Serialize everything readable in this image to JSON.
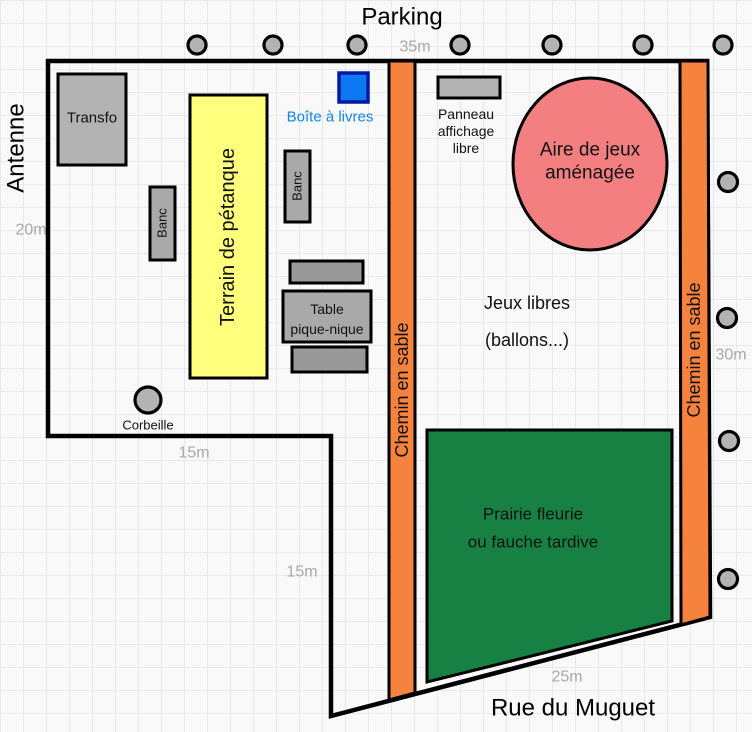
{
  "diagram": {
    "titles": {
      "parking": "Parking",
      "antenne": "Antenne",
      "rue_du_muguet": "Rue du Muguet"
    },
    "dimensions": {
      "top": "35m",
      "left": "20m",
      "right": "30m",
      "inner_west": "15m",
      "inner_south": "15m",
      "road": "25m"
    },
    "zones": {
      "terrain_petanque": {
        "label": "Terrain de pétanque",
        "fill": "#ffff7d"
      },
      "aire_de_jeux": {
        "lines": [
          "Aire de jeux",
          "aménagée"
        ],
        "fill": "#f47f80"
      },
      "prairie": {
        "lines": [
          "Prairie fleurie",
          "ou fauche tardive"
        ],
        "fill": "#178143"
      },
      "jeux_libres": {
        "lines": [
          "Jeux libres",
          "(ballons...)"
        ]
      },
      "chemin_ouest": {
        "label": "Chemin en sable",
        "fill": "#f5823d"
      },
      "chemin_est": {
        "label": "Chemin en sable",
        "fill": "#f5823d"
      }
    },
    "equipments": {
      "transfo": {
        "label": "Transfo",
        "fill": "#b3b3b3"
      },
      "boite_a_livres": {
        "label": "Boîte à livres",
        "fill": "#0b78f0",
        "stroke": "#0718a4",
        "label_color": "#1086e8"
      },
      "panneau_affichage": {
        "lines": [
          "Panneau",
          "affichage",
          "libre"
        ],
        "fill": "#b3b3b3"
      },
      "banc_ouest": {
        "label": "Banc",
        "fill": "#a9a9a9"
      },
      "banc_est": {
        "label": "Banc",
        "fill": "#a9a9a9"
      },
      "bench_slat_fill": "#999999",
      "table_pique_nique": {
        "lines": [
          "Table",
          "pique-nique"
        ],
        "fill": "#a9a9a9"
      },
      "corbeille": {
        "label": "Corbeille",
        "fill": "#b3b3b3"
      },
      "arbres_parking_count": 7,
      "arbustes_est_count": 4
    },
    "colors": {
      "background": "#f9f9f9",
      "grid": "#e8e8e8",
      "outline": "#000000",
      "dim_label": "#a9a9a9"
    }
  }
}
